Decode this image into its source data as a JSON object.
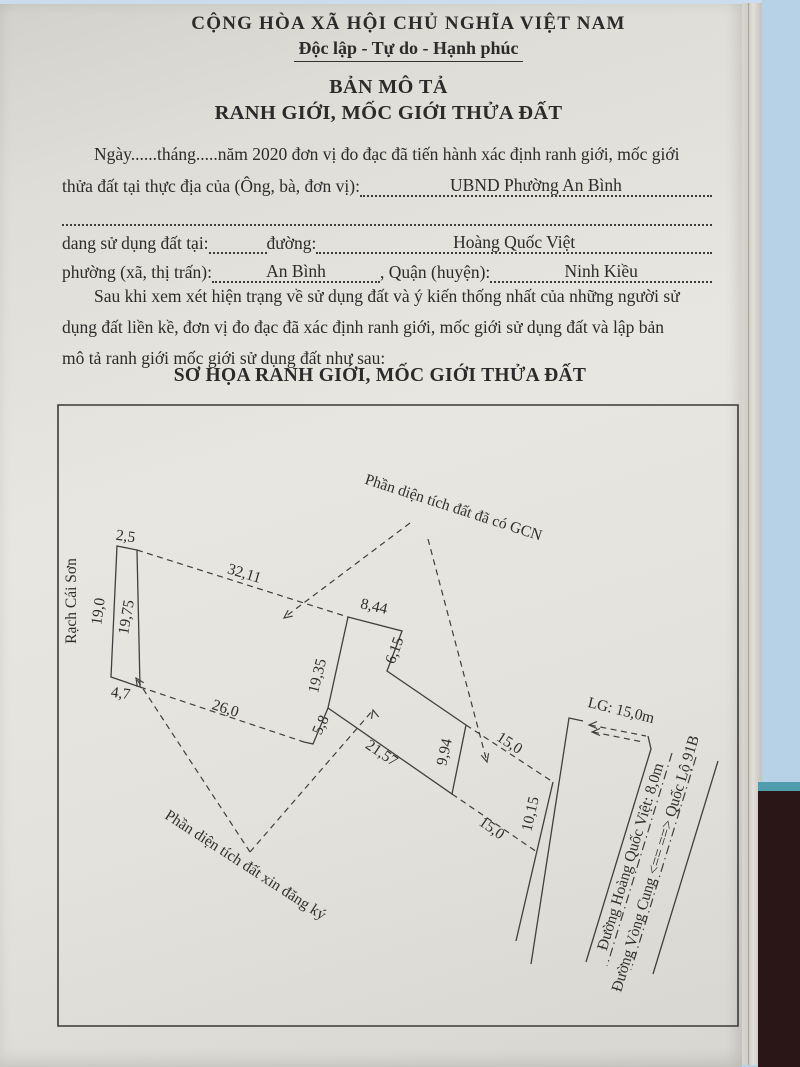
{
  "document": {
    "header": {
      "country": "CỘNG HÒA XÃ HỘI CHỦ NGHĨA VIỆT NAM",
      "motto": "Độc lập - Tự do - Hạnh phúc"
    },
    "title": {
      "line1": "BẢN MÔ TẢ",
      "line2": "RANH GIỚI, MỐC GIỚI THỬA ĐẤT"
    },
    "intro": {
      "line1": "Ngày......tháng.....năm 2020 đơn vị đo đạc đã tiến hành xác định ranh giới, mốc giới",
      "line2_label": "thửa đất tại thực địa của (Ông, bà, đơn vị):",
      "line2_value": "UBND Phường An Bình",
      "line4_label1": "dang sử dụng đất tại:",
      "line4_label2": "đường:",
      "line4_value": "Hoàng Quốc Việt",
      "line5_label1": "phường (xã, thị trấn):",
      "line5_value1": "An Bình",
      "line5_label2": ", Quận (huyện):",
      "line5_value2": "Ninh Kiều",
      "para2_line1": "Sau khi xem xét hiện trạng về sử dụng đất và ý kiến thống nhất của những người sử",
      "para2_line2": "dụng đất liền kề, đơn vị đo đạc đã xác định ranh giới, mốc giới sử dụng đất và lập bản",
      "para2_line3": "mô tả ranh giới mốc giới sử dụng đất như sau:"
    },
    "sketch_heading": "SƠ HỌA RANH GIỚI, MỐC GIỚI THỬA ĐẤT"
  },
  "diagram": {
    "waterway_label": "Rạch Cái Sơn",
    "area_with_certificate": "Phần diện tích đất đã có GCN",
    "area_requested": "Phần diện tích đất xin đăng ký",
    "road_setback": "LG: 15,0m",
    "road_main": "Đường Hoàng Quốc Việt: 8,0m",
    "road_direction": "Đường Vòng Cung <==  ==> Quốc Lộ 91B",
    "dimensions": {
      "d2_5": "2,5",
      "d19_0": "19,0",
      "d19_75": "19,75",
      "d4_7": "4,7",
      "d32_11": "32,11",
      "d26_0": "26,0",
      "d8_44": "8,44",
      "d6_15": "6,15",
      "d19_35": "19,35",
      "d5_8": "5,8",
      "d21_57": "21,57",
      "d9_94": "9,94",
      "d15_0a": "15,0",
      "d15_0b": "15,0",
      "d10_15": "10,15"
    }
  },
  "photo_background_colors": {
    "desk_blue": "#b7d2e6",
    "dark_surface": "#2a1517",
    "teal_edge": "#4f9dab",
    "paper": "#e6e4de"
  }
}
